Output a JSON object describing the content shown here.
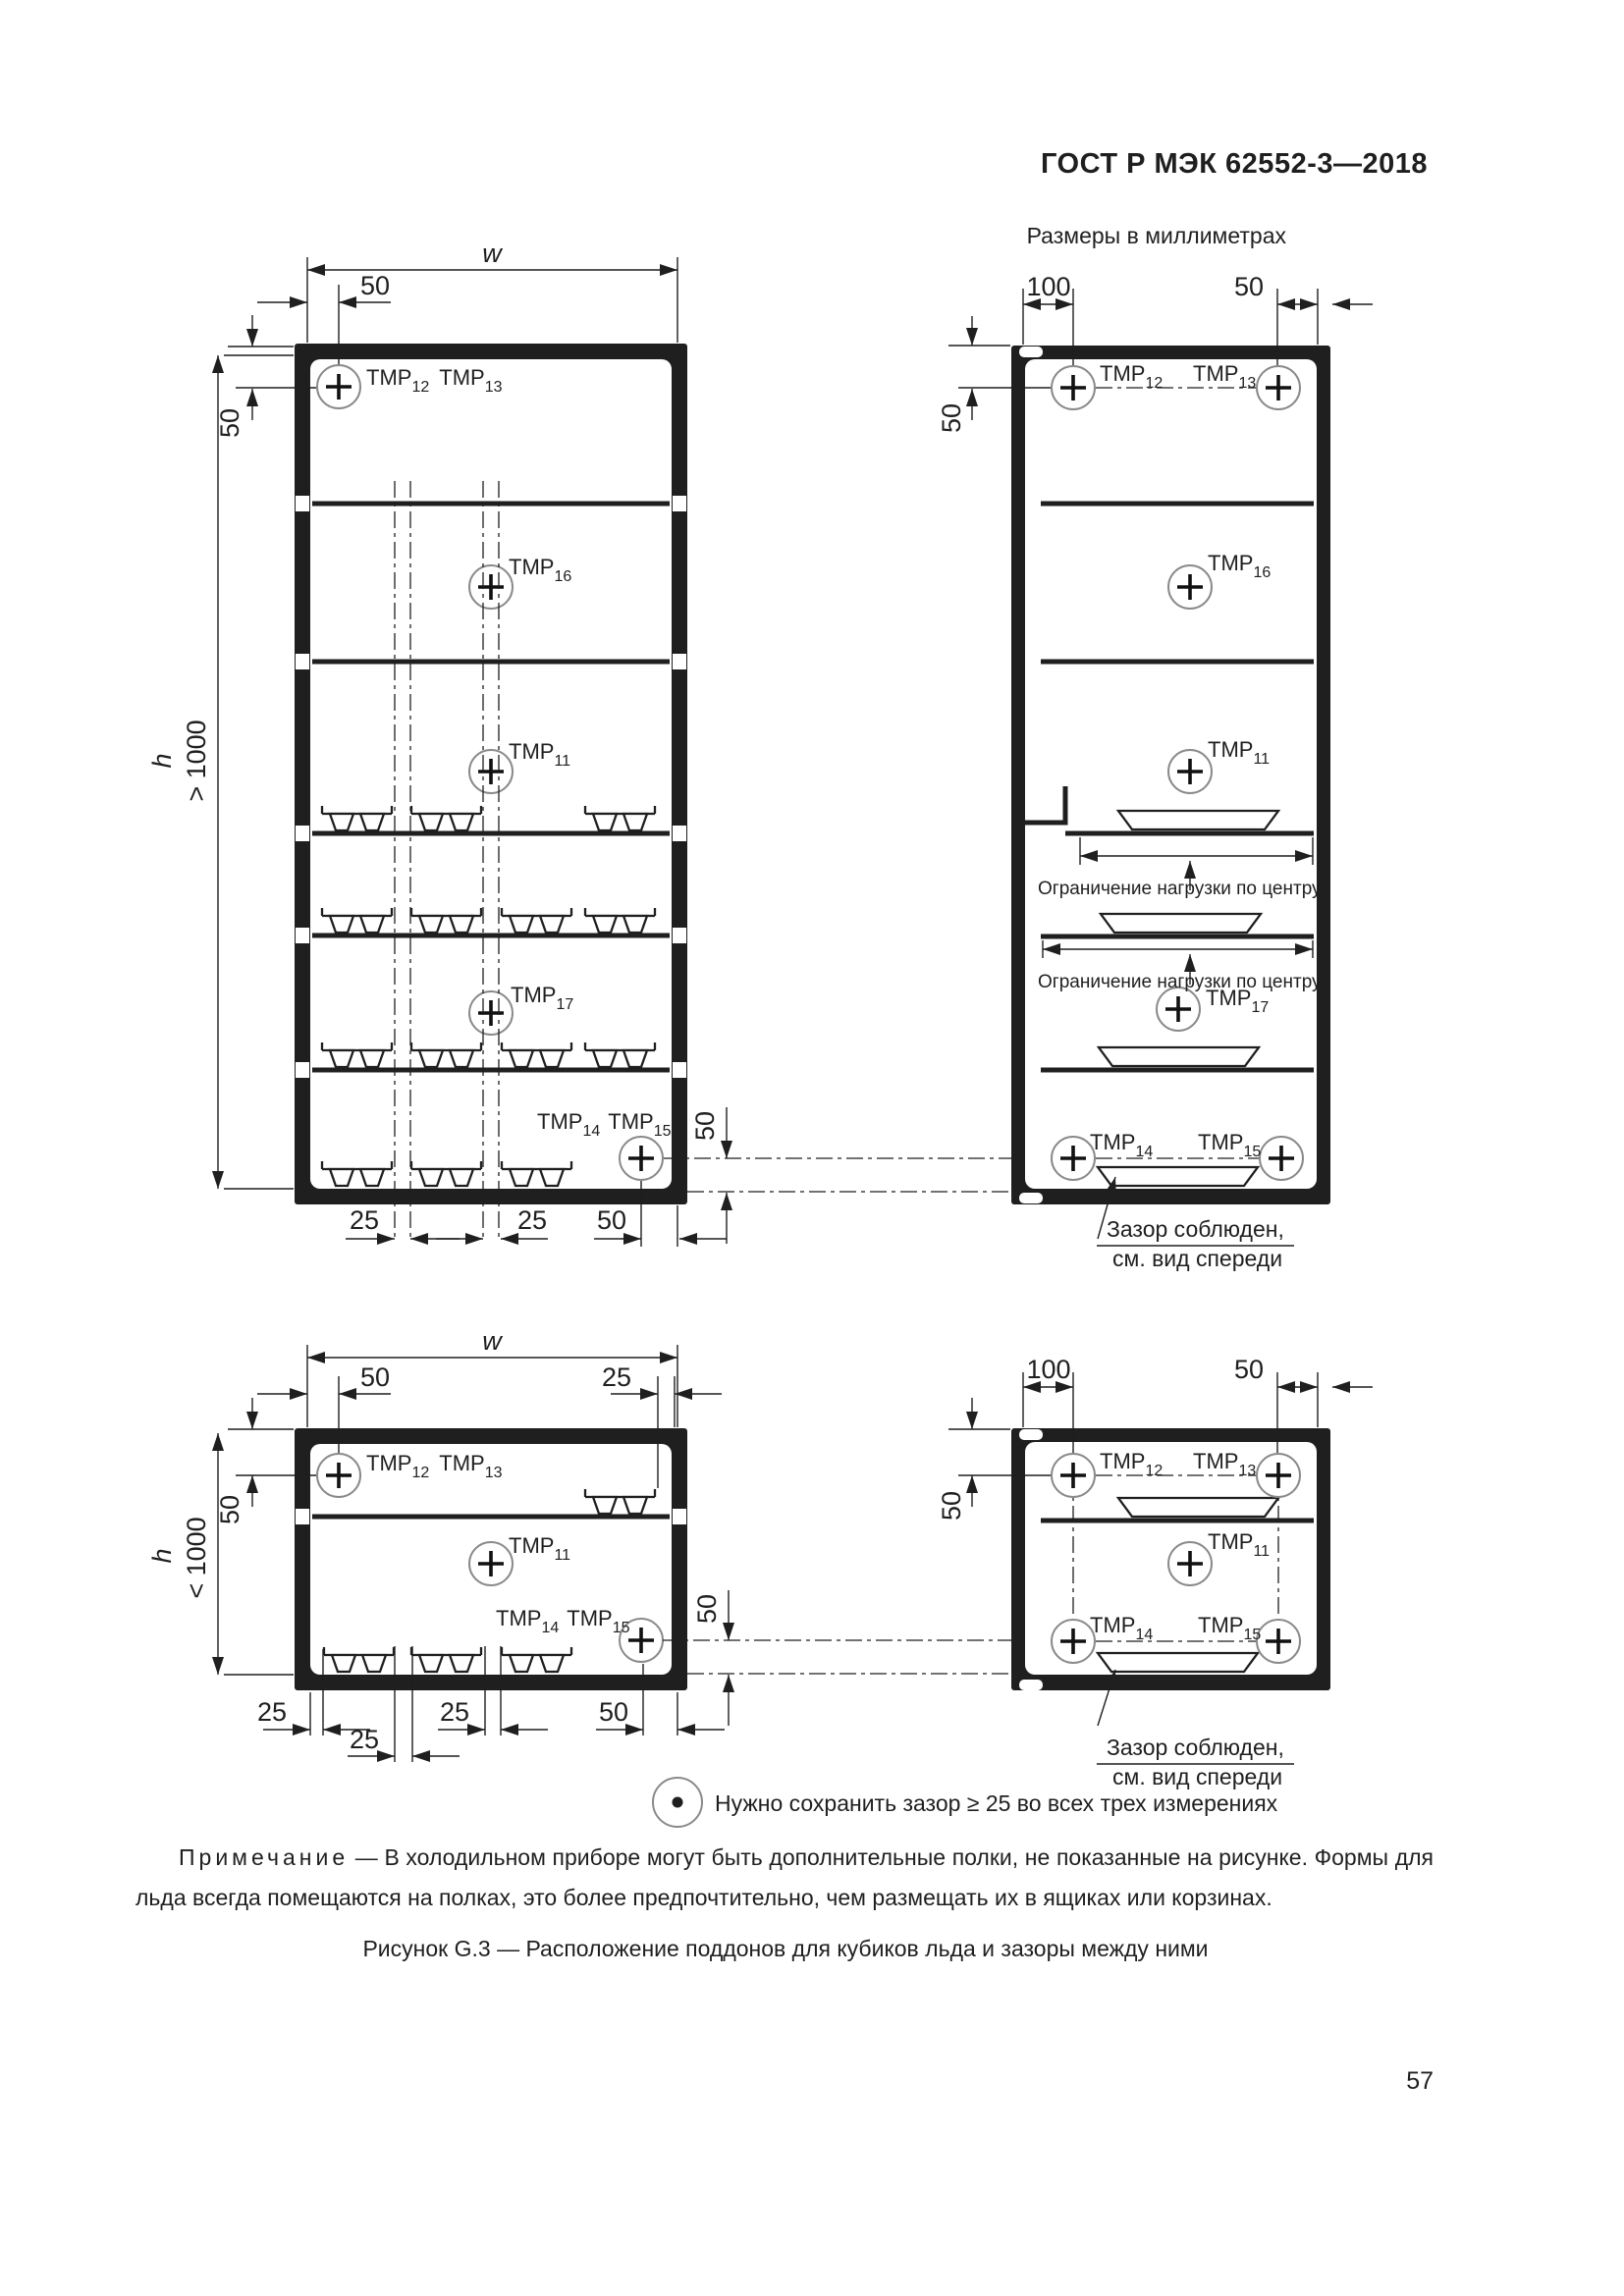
{
  "document": {
    "header": "ГОСТ Р МЭК 62552-3—2018",
    "units_note": "Размеры в миллиметрах",
    "note": {
      "label": "Примечание",
      "body": "— В холодильном приборе могут быть дополнительные полки, не показанные на рисунке. Формы для льда всегда помещаются на полках, это более предпочтительно, чем размещать их в ящиках или корзинах."
    },
    "caption": "Рисунок G.3 — Расположение поддонов для кубиков льда и зазоры между ними",
    "page_number": "57"
  },
  "legend": {
    "symbol": "circled-dot-icon",
    "text": "Нужно сохранить зазор ≥ 25 во всех трех измерениях"
  },
  "dims": {
    "w": "w",
    "h": "h",
    "gt1000": "> 1000",
    "lt1000": "< 1000",
    "d25": "25",
    "d50": "50",
    "d100": "100"
  },
  "tmp": {
    "prefix": "TMP",
    "s11": "11",
    "s12": "12",
    "s13": "13",
    "s14": "14",
    "s15": "15",
    "s16": "16",
    "s17": "17"
  },
  "annotations": {
    "load_limit": "Ограничение нагрузки по центру",
    "gap_line1": "Зазор соблюден,",
    "gap_line2": "см. вид спереди"
  }
}
